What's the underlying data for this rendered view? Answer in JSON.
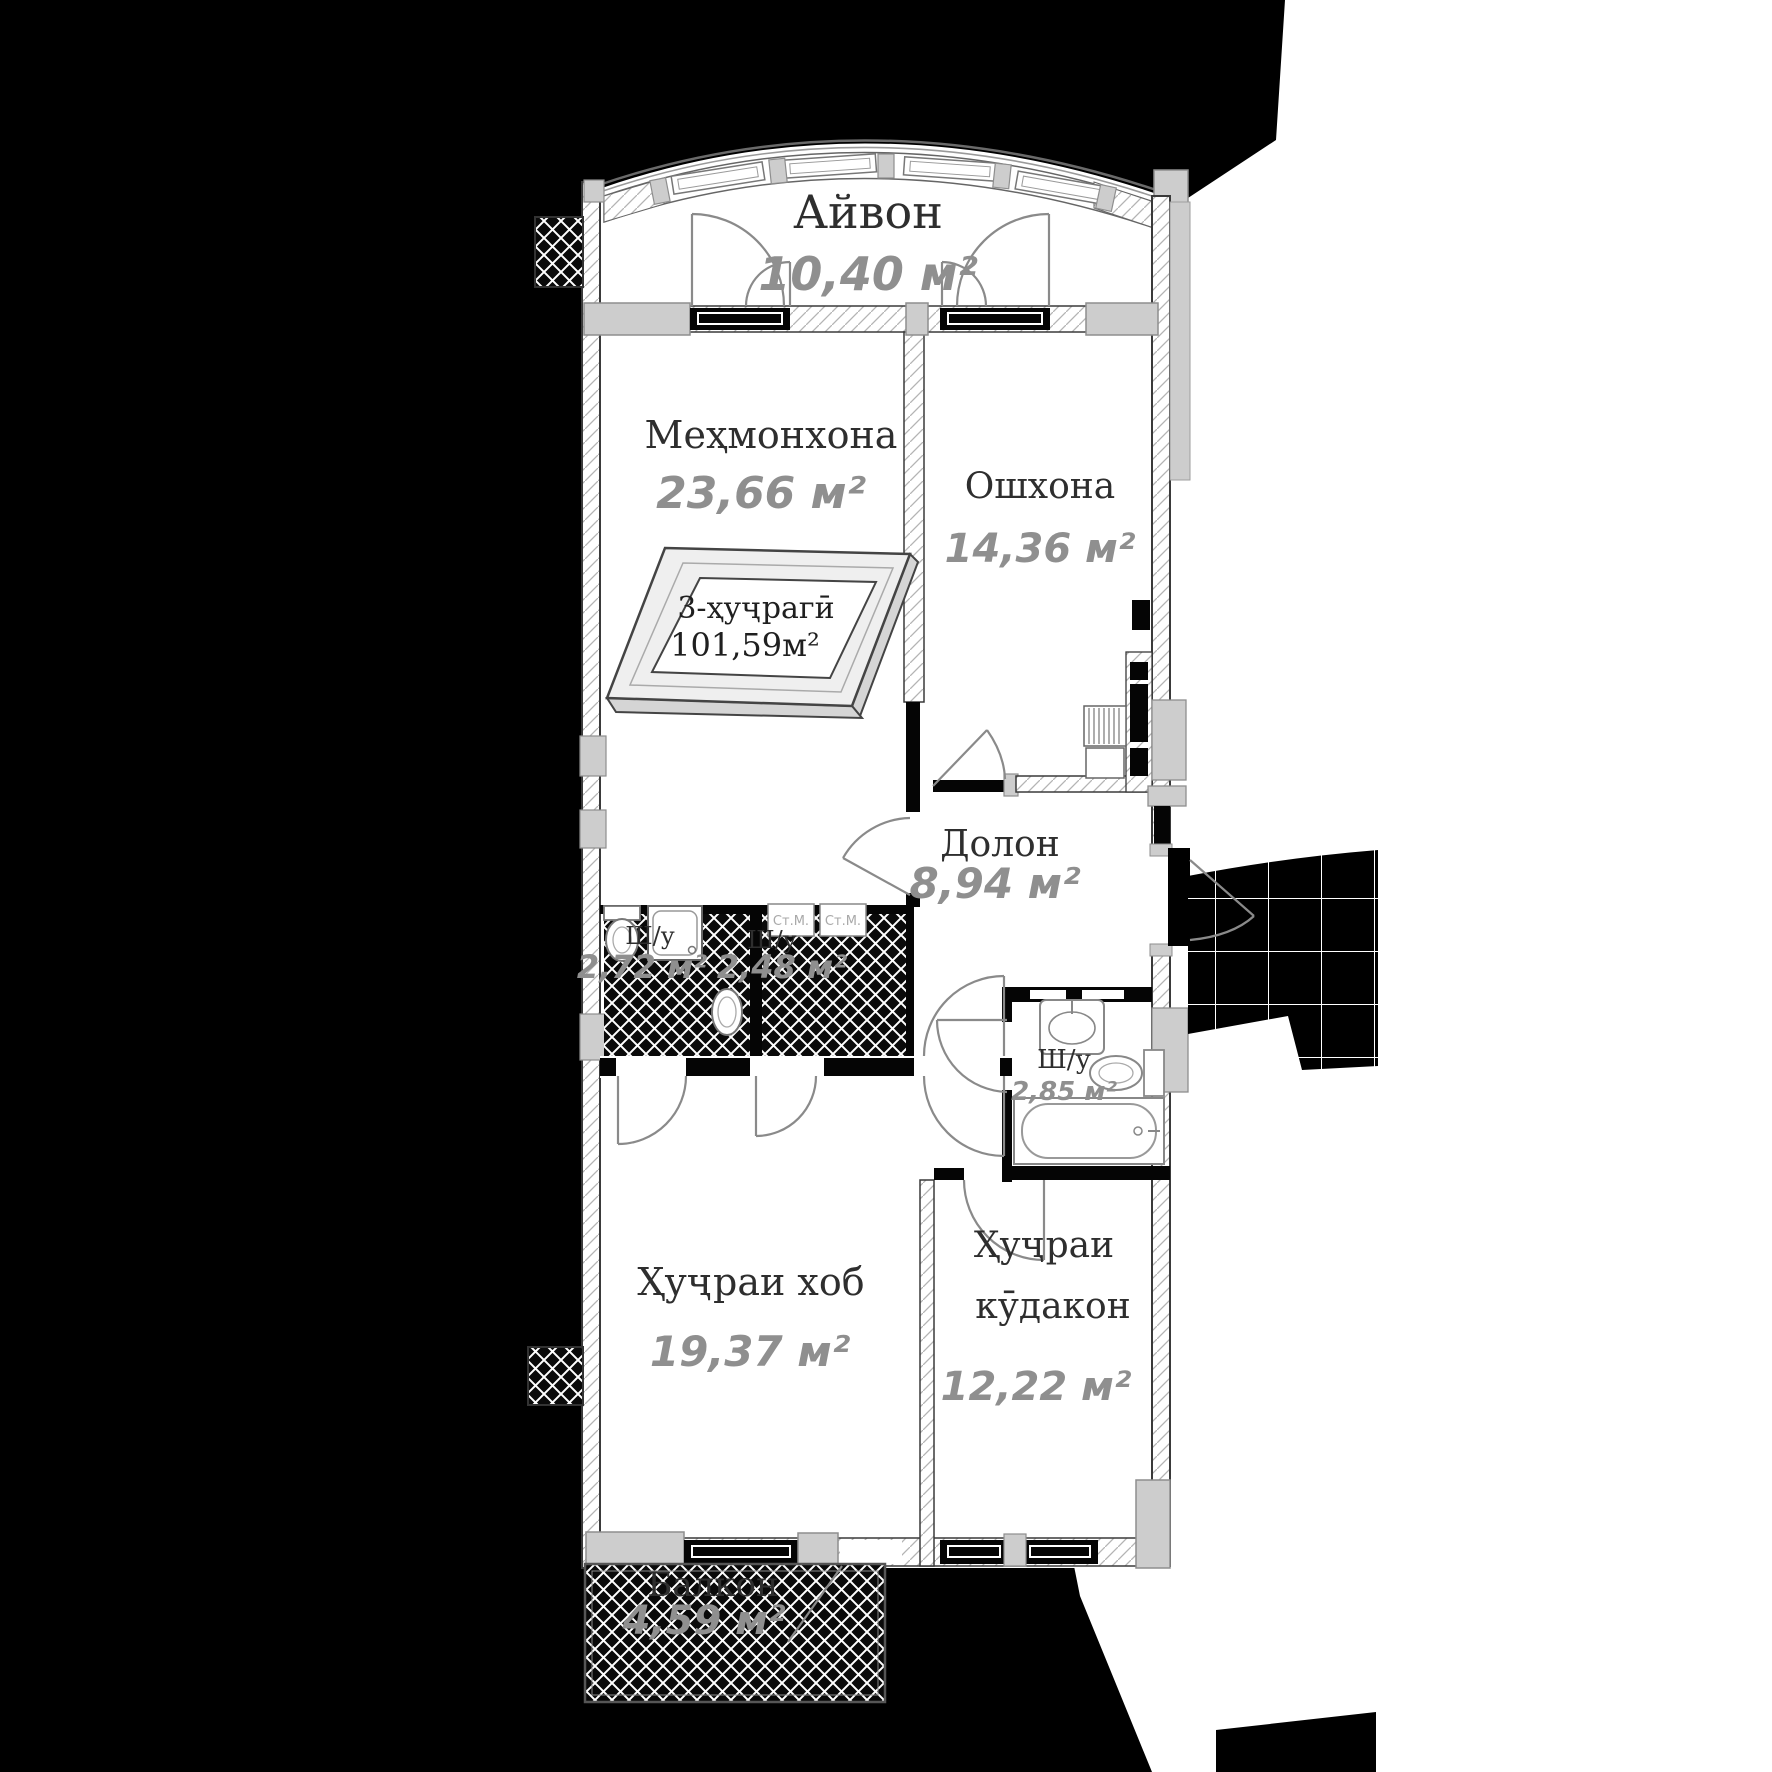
{
  "rooms": {
    "veranda": {
      "name": "Айвон",
      "area": "10,40 м²"
    },
    "living": {
      "name": "Меҳмонхона",
      "area": "23,66 м²"
    },
    "kitchen": {
      "name": "Ошхона",
      "area": "14,36 м²"
    },
    "hall": {
      "name": "Долон",
      "area": "8,94 м²"
    },
    "bath1": {
      "name": "Ш/у",
      "area": "2,72 м²"
    },
    "bath2": {
      "name": "Ш/у",
      "area": "2,48 м²"
    },
    "bath3": {
      "name": "Ш/у",
      "area": "2,85 м²"
    },
    "bedroom": {
      "name": "Ҳуҷраи хоб",
      "area": "19,37 м²"
    },
    "kids": {
      "name1": "Ҳуҷраи",
      "name2": "кӯдакон",
      "area": "12,22 м²"
    },
    "balcony": {
      "name": "Балкон",
      "area": "4,59 м²"
    }
  },
  "summary": {
    "type_label": "3-ҳуҷрагӣ",
    "total_area": "101,59м²"
  },
  "appliances": {
    "washer_label": "Ст.М."
  },
  "colors": {
    "background": "#000000",
    "floor": "#ffffff",
    "wall": "#3a3a3a",
    "concrete": "#cdcdcd",
    "room_name_text": "#2e2e2e",
    "area_text": "#8f8f8f"
  }
}
